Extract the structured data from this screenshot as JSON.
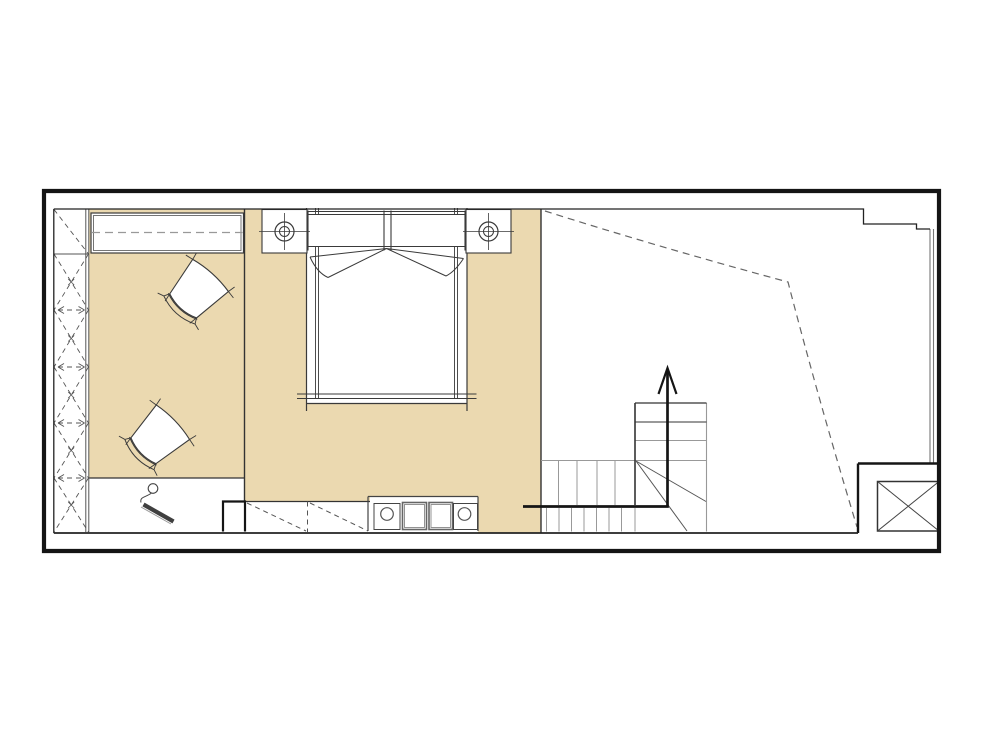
{
  "canvas": {
    "width": 1000,
    "height": 748,
    "background": "#ffffff"
  },
  "colors": {
    "floor_accent": "#ebd9b0",
    "wall": "#151515",
    "line_dark": "#333333",
    "line_medium": "#555555",
    "line_light": "#999999",
    "furniture_line": "#3a3a3a",
    "dashed_gray": "#666666",
    "white": "#ffffff"
  },
  "plan": {
    "kind": "architectural-floor-plan",
    "level": "single floor with staircase going up",
    "stairs": {
      "direction": "up",
      "symbol": "up-arrow"
    },
    "elements": [
      {
        "name": "wardrobe-left",
        "symbol": "dashed-x-cabinet-run"
      },
      {
        "name": "dresser-top-left",
        "symbol": "double-line-cabinet-with-dashed-centerline"
      },
      {
        "name": "armchair-1",
        "symbol": "rotated-armchair"
      },
      {
        "name": "armchair-2",
        "symbol": "rotated-armchair"
      },
      {
        "name": "double-bed",
        "symbol": "bed-with-canopy-drape-and-foot-fold"
      },
      {
        "name": "nightstand-left",
        "symbol": "square-table-with-round-lamp"
      },
      {
        "name": "nightstand-right",
        "symbol": "square-table-with-round-lamp"
      },
      {
        "name": "wall-lamp-desk-area",
        "symbol": "small-lamp-with-cord"
      },
      {
        "name": "lower-closet",
        "symbol": "dashed-sliding-front-cabinet"
      },
      {
        "name": "vanity-counter",
        "symbol": "counter-two-square-units-two-round-fixtures"
      },
      {
        "name": "staircase",
        "symbol": "l-shaped-stair-with-winders"
      },
      {
        "name": "duct-shaft",
        "symbol": "crossed-box"
      },
      {
        "name": "window-right",
        "symbol": "double-line-glazing"
      },
      {
        "name": "ceiling-break-line",
        "symbol": "dashed-polyline"
      }
    ]
  }
}
